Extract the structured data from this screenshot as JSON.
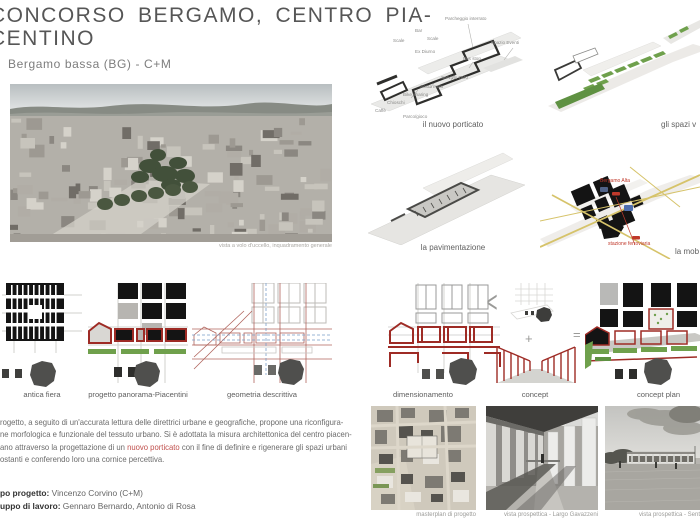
{
  "header": {
    "title_line1": "CONCORSO BERGAMO, CENTRO PIA-",
    "title_line2": "CENTINO",
    "subtitle": "Bergamo bassa (BG) - C+M"
  },
  "render": {
    "caption": "vista a volo d'uccello, inquadramento generale"
  },
  "left_diagrams": {
    "items": [
      {
        "label": "antica fiera"
      },
      {
        "label": "progetto panorama-Piacentini"
      },
      {
        "label": "geometria descrittiva"
      }
    ]
  },
  "paragraph": {
    "line1": "rogetto, a seguito di un'accurata lettura delle direttrici urbane e geografiche, propone una riconfigura-",
    "line2": "ne morfologica e funzionale del tessuto urbano. Si è adottata la misura architettonica del centro piacen-",
    "line3_pre": "ano attraverso la progettazione di un ",
    "line3_red": "nuovo porticato",
    "line3_post": " con il fine di definire e rigenerare gli spazi urbani",
    "line4": "ostanti e conferendo loro una cornice percettiva."
  },
  "credits": {
    "label1": "po progetto:",
    "value1": " Vincenzo Corvino (C+M)",
    "label2": "uppo di lavoro:",
    "value2": " Gennaro Bernardo, Antonio di Rosa"
  },
  "right_diagrams": {
    "porticato": {
      "caption": "il nuovo porticato",
      "labels": [
        "Parcheggio interrato",
        "Bar",
        "Scale",
        "Scale",
        "Ex Diurno",
        "Spazio Eventi",
        "Bus stop",
        "Servizio TAXI",
        "Sosta moto",
        "Bike sharing",
        "Chioschi",
        "Caffè",
        "Parco/gioco"
      ]
    },
    "verde": {
      "caption": "gli spazi v"
    },
    "pavimentazione": {
      "caption": "la pavimentazione"
    },
    "mobilita": {
      "caption": "la mob",
      "label_bergamo_alta": "Bergamo Alta",
      "label_stazione": "stazione ferroviaria"
    },
    "dimensionamento": {
      "caption": "dimensionamento"
    },
    "concept": {
      "caption": "concept",
      "less": "<",
      "plus": "+",
      "equals": "="
    },
    "concept_plan": {
      "caption": "concept plan"
    }
  },
  "photos": {
    "items": [
      {
        "caption": "masterplan di progetto"
      },
      {
        "caption": "vista prospettica - Largo Gavazzeni"
      },
      {
        "caption": "vista prospettica - Sent"
      }
    ]
  },
  "colors": {
    "accent_red": "#c0504d",
    "diagram_red": "#9e2b25",
    "green": "#6fa04c",
    "black_block": "#141414",
    "gray_blob": "#4f4f4d",
    "yellow_road": "#d6c36a",
    "blue_parking": "#4f6fae"
  }
}
